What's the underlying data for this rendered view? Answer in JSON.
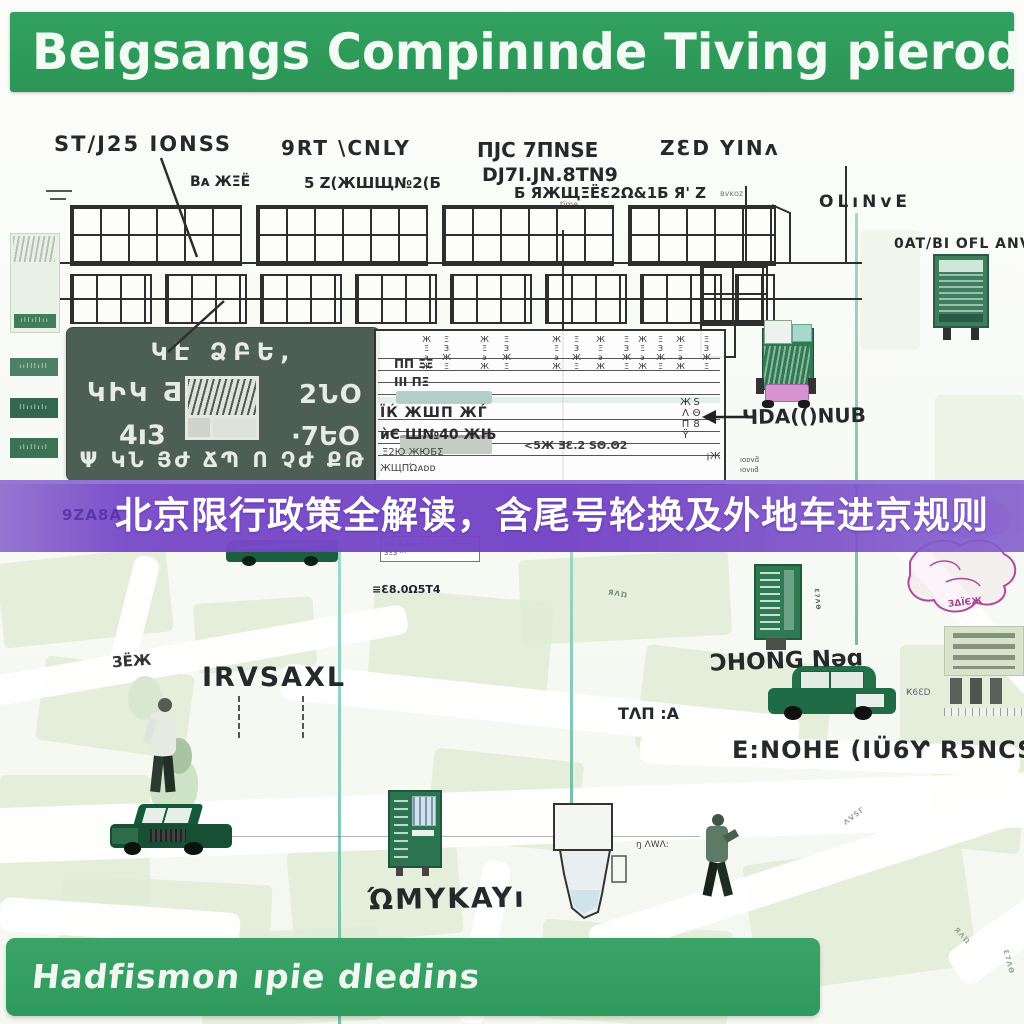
{
  "header": {
    "title": "Beigsangs Compinınde Tiving pierodirs,"
  },
  "colors": {
    "header_green": "#2d9c5a",
    "footer_green": "#37a065",
    "banner_purple": "#7a4ecb",
    "sign_green": "#4d5f54",
    "teal_line": "#7cc7b2",
    "truck_pink": "#d693d1",
    "map_pink": "#b2489e"
  },
  "top_labels": {
    "stj": "ST/J25 IONSS",
    "srt": "9RT \\CNLY",
    "djg": "ПJС 7ΠNSE",
    "dj7": "DJ7I.JN.8TN9",
    "zed": "ZƐD YINᴧ",
    "oline": "OLıNᴠE",
    "oatbl": "0AT/BΙ OFL ANV",
    "cap1": "Bᴀ ЖΞЁ",
    "cap2": "5 Z(ЖШЩ№2(Б",
    "cap3": "Б ЯЖЩΞЁ",
    "cap3s": "tïme.",
    "cap4": "Ɛ2Ω&1Б Я' Z",
    "cap4s": "ʙᴠᴋᴏᴢ"
  },
  "strip": {
    "b1": "ıllıllıı",
    "b2": "ıılllıll",
    "b3": "llıılılı",
    "b4": "ılıllııl"
  },
  "sign": {
    "line1": "ԿԷ ՁԲԵ,",
    "left1": "ԿԻԿ Ƌ·",
    "left2": "4ı3",
    "right1": "2ՆO",
    "right2": "·7ԵO",
    "bottom": "Ψ ԿՆ ՅԺ ՃՊ Ո ՉԺ ՔԹ"
  },
  "table": {
    "col_glyph": "ЖΞ϶Ж",
    "col_glyph2": "ΞЗЖΞ",
    "left1": "ΠΠ ΞΞ",
    "left2": "ΙΙΙ ΠΞ",
    "mid1": "ЇЌ ЖШΠ ЖЃ",
    "mid2": "ѝЄ Ш№40 ЖЊ",
    "mid3": "Ξ2Ю ЖЮБΣ",
    "note": "<5Ж ƎƐ.2 ЅΘ.Θ2",
    "right1": "ЅΘ8 ЖΛΠΫ",
    "right2": "ıᴏᴅᴠƌ",
    "right2b": "ıoᴠııƌ",
    "bottom1": "ЖЩΠΏᴀᴅᴅ",
    "b_right": "¡Ж",
    "mini1": "≡Ξ Ж33Ξ ΞЗ",
    "mini2": "3Ξ3 ···"
  },
  "banner": {
    "watermark": "9ZA8A",
    "title": "北京限行政策全解读，含尾号轮换及外地车进京规则"
  },
  "mid_labels": {
    "irisaxl": "IRVSAXL",
    "left_glyphs": "ЗЁЖ",
    "chong": "ƆHONG Nǝɑ",
    "taj": "TΛΠ :A",
    "dmc": "ЧDA(()NUB",
    "enohe": "E:NOHE (IÜ6Ƴ R5NCS",
    "wkay": "ΏMYKAYı",
    "fuel": "≡Ɛ8.0Ω5T4",
    "pink": "ЗΔΪЄЖ",
    "awa": "ŋ ΛWΛ:",
    "k6d": "Ҝ6ƐD"
  },
  "map_labels": {
    "l1": "ΛVSΓ",
    "l2": "ЯΛΏ",
    "l3": "Ɛ7ΛΘ",
    "l4": "ΞΘΪ"
  },
  "footer": {
    "title": "Hadfismon ıpie dledins"
  }
}
